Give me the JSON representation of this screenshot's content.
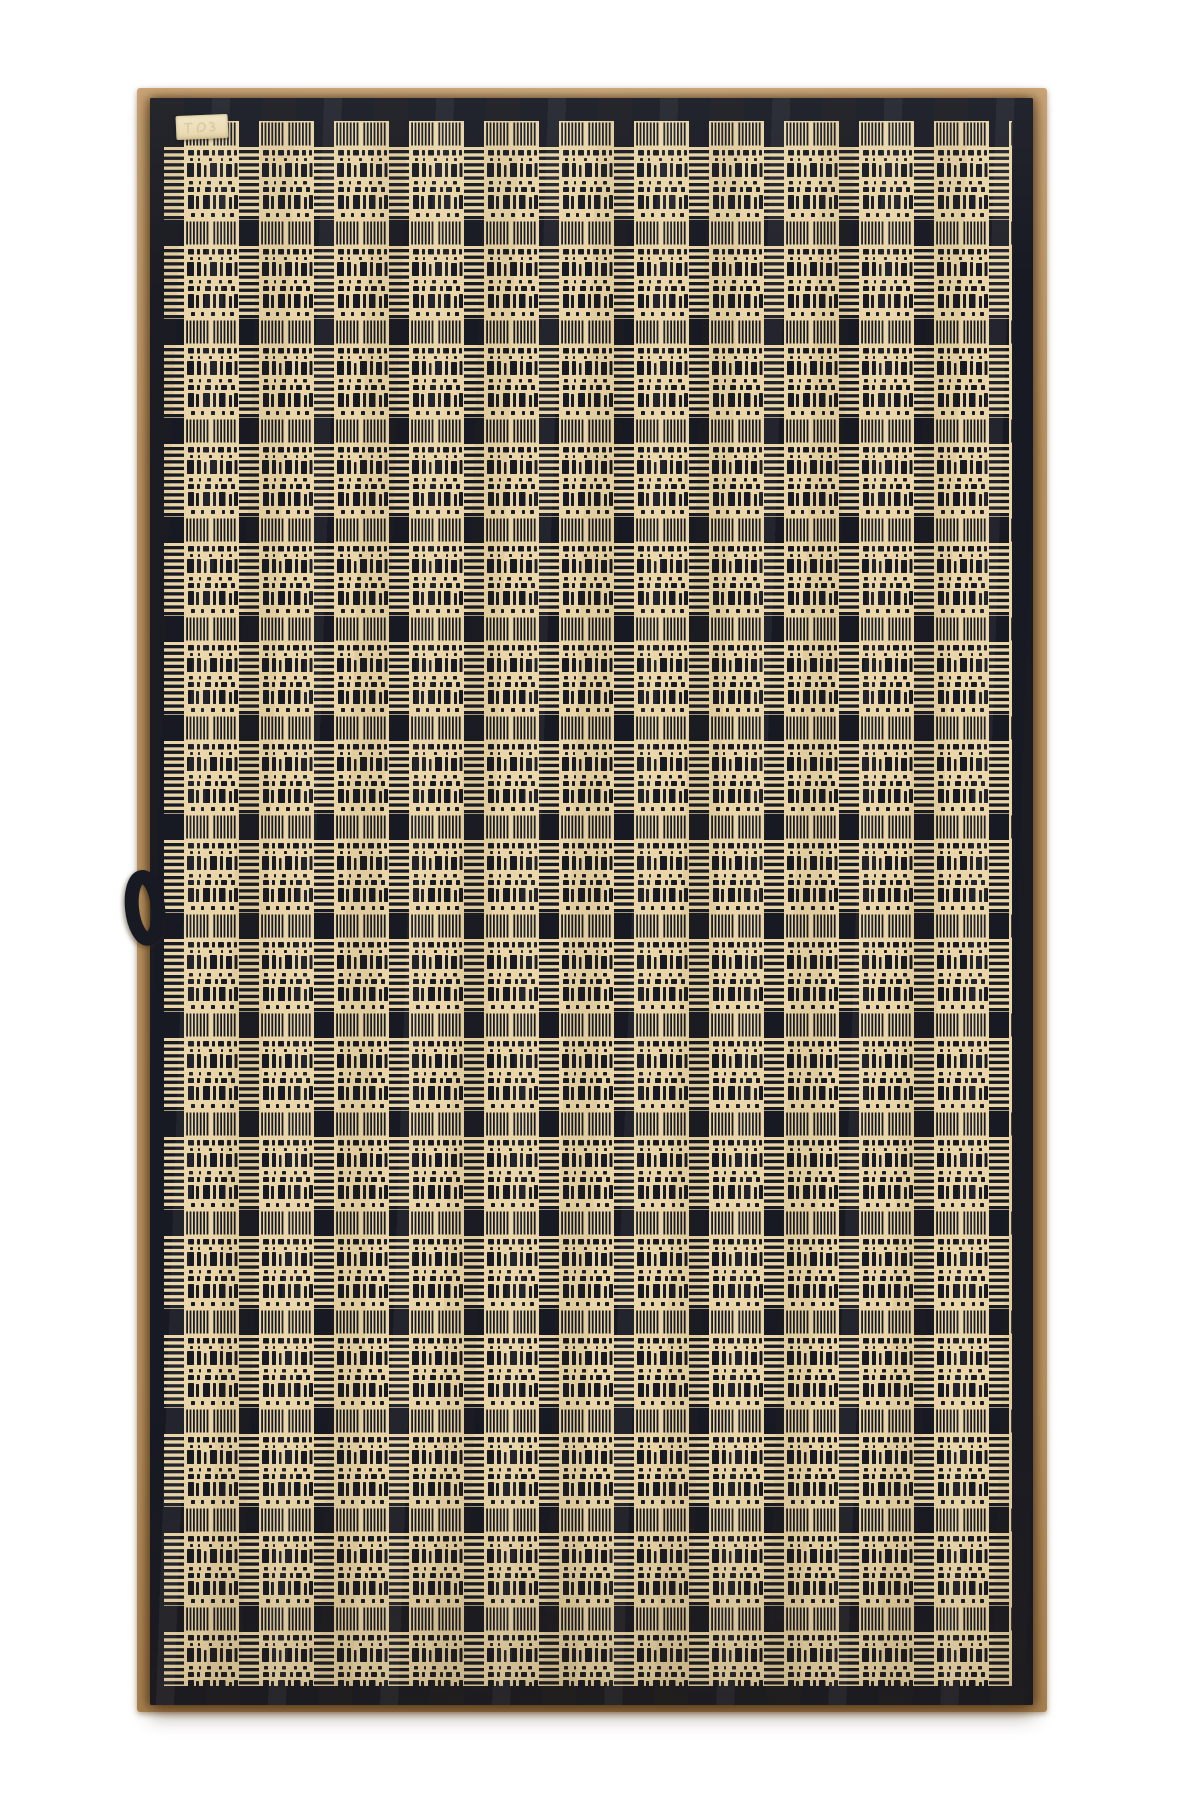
{
  "meta": {
    "alt_text": "Navy blue and cream checked jacquard towel with hanging loop and blank woven tag, photographed hanging flat on a tan board over a white background",
    "visible_text": ""
  },
  "palette": {
    "page_white": "#ffffff",
    "board_tan": "#c7a06d",
    "board_tan_light": "#d2ac7c",
    "board_tan_dark": "#b9905e",
    "towel_navy": "#181a23",
    "towel_cream": "#e9d5a7",
    "tag_cream": "#eadcb6",
    "tag_mark": "#cdb98c"
  },
  "towel": {
    "pattern_type": "windowpane check jacquard",
    "grid_columns": 11,
    "grid_rows": 16,
    "tile_width": 75,
    "tile_height": 99,
    "band_width": 20,
    "band_height": 26,
    "has_hanging_loop": true,
    "has_brand_tag": true,
    "hems": [
      "top",
      "bottom",
      "left",
      "right"
    ]
  }
}
